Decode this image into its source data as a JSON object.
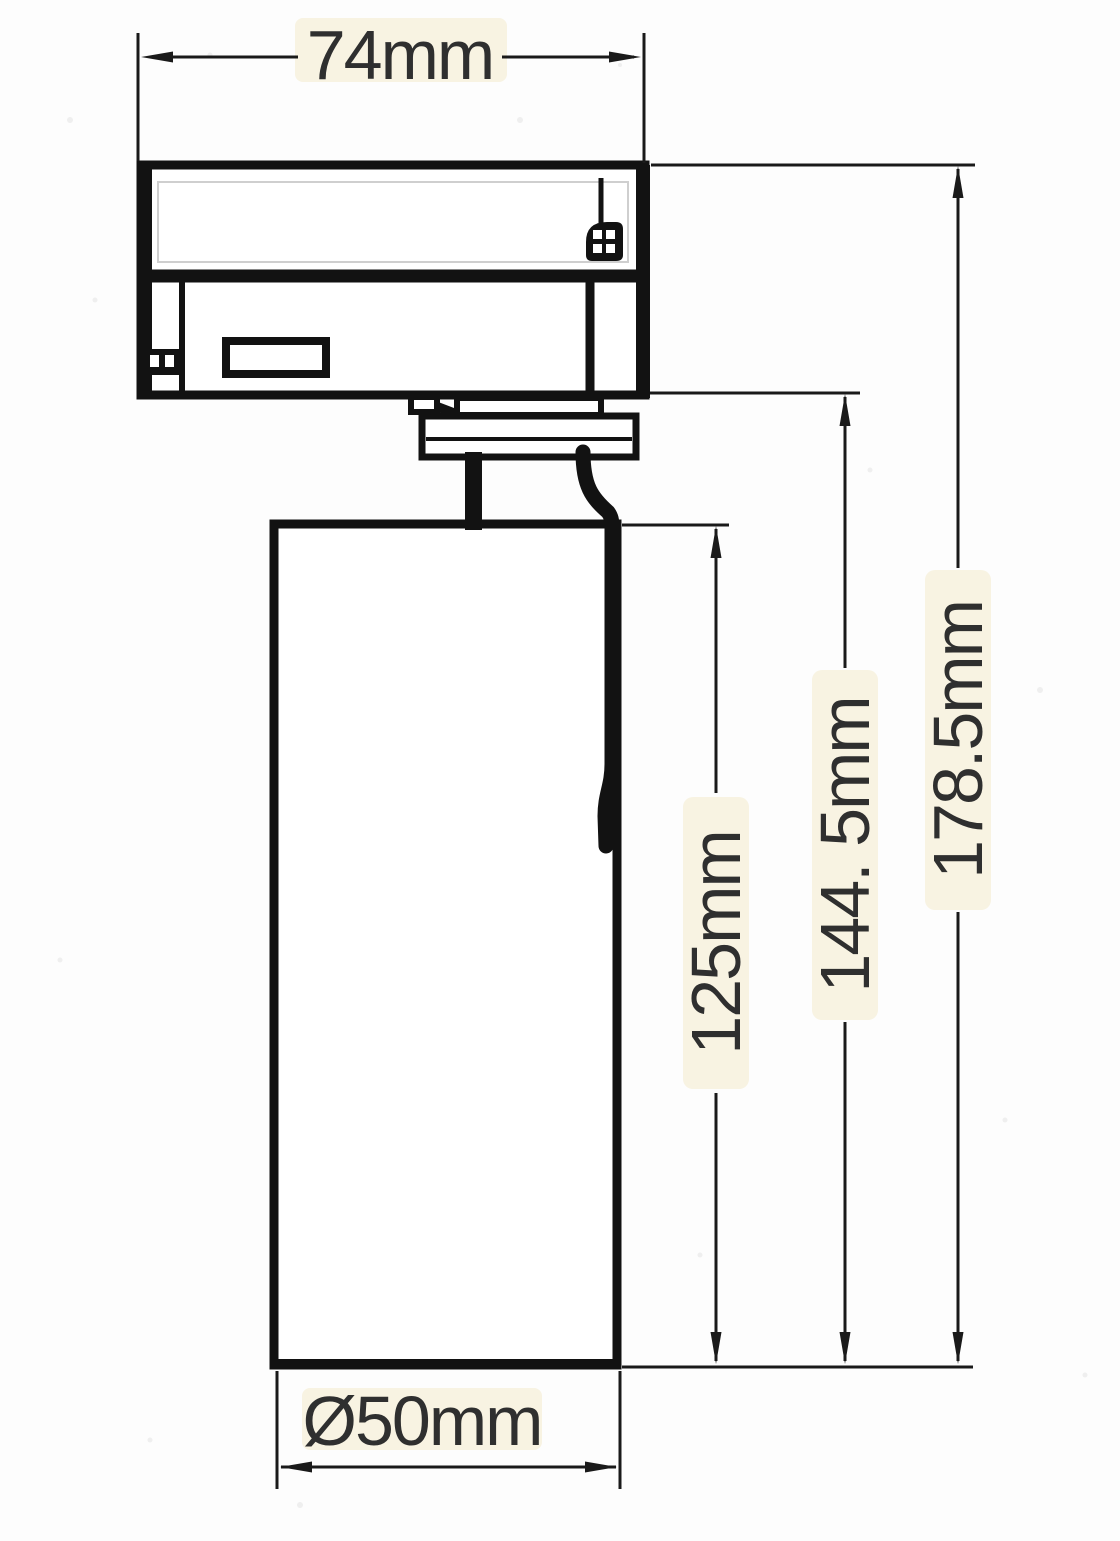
{
  "document": {
    "kind": "technical dimension drawing",
    "subject": "track spotlight side profile"
  },
  "colors": {
    "background": "#fdfdfd",
    "line": "#121212",
    "label_text": "#2f2f2f",
    "paper_tint": "#f8f3e2"
  },
  "dimensions": {
    "adapter_width": {
      "label": "74mm",
      "orientation": "horizontal",
      "position": "top"
    },
    "body_length": {
      "label": "125mm",
      "orientation": "vertical",
      "position": "inner-right"
    },
    "stem_length": {
      "label": "144. 5mm",
      "orientation": "vertical",
      "position": "middle-right"
    },
    "overall_length": {
      "label": "178.5mm",
      "orientation": "vertical",
      "position": "outer-right"
    },
    "body_diameter": {
      "label": "Ø50mm",
      "orientation": "horizontal",
      "position": "bottom"
    }
  }
}
